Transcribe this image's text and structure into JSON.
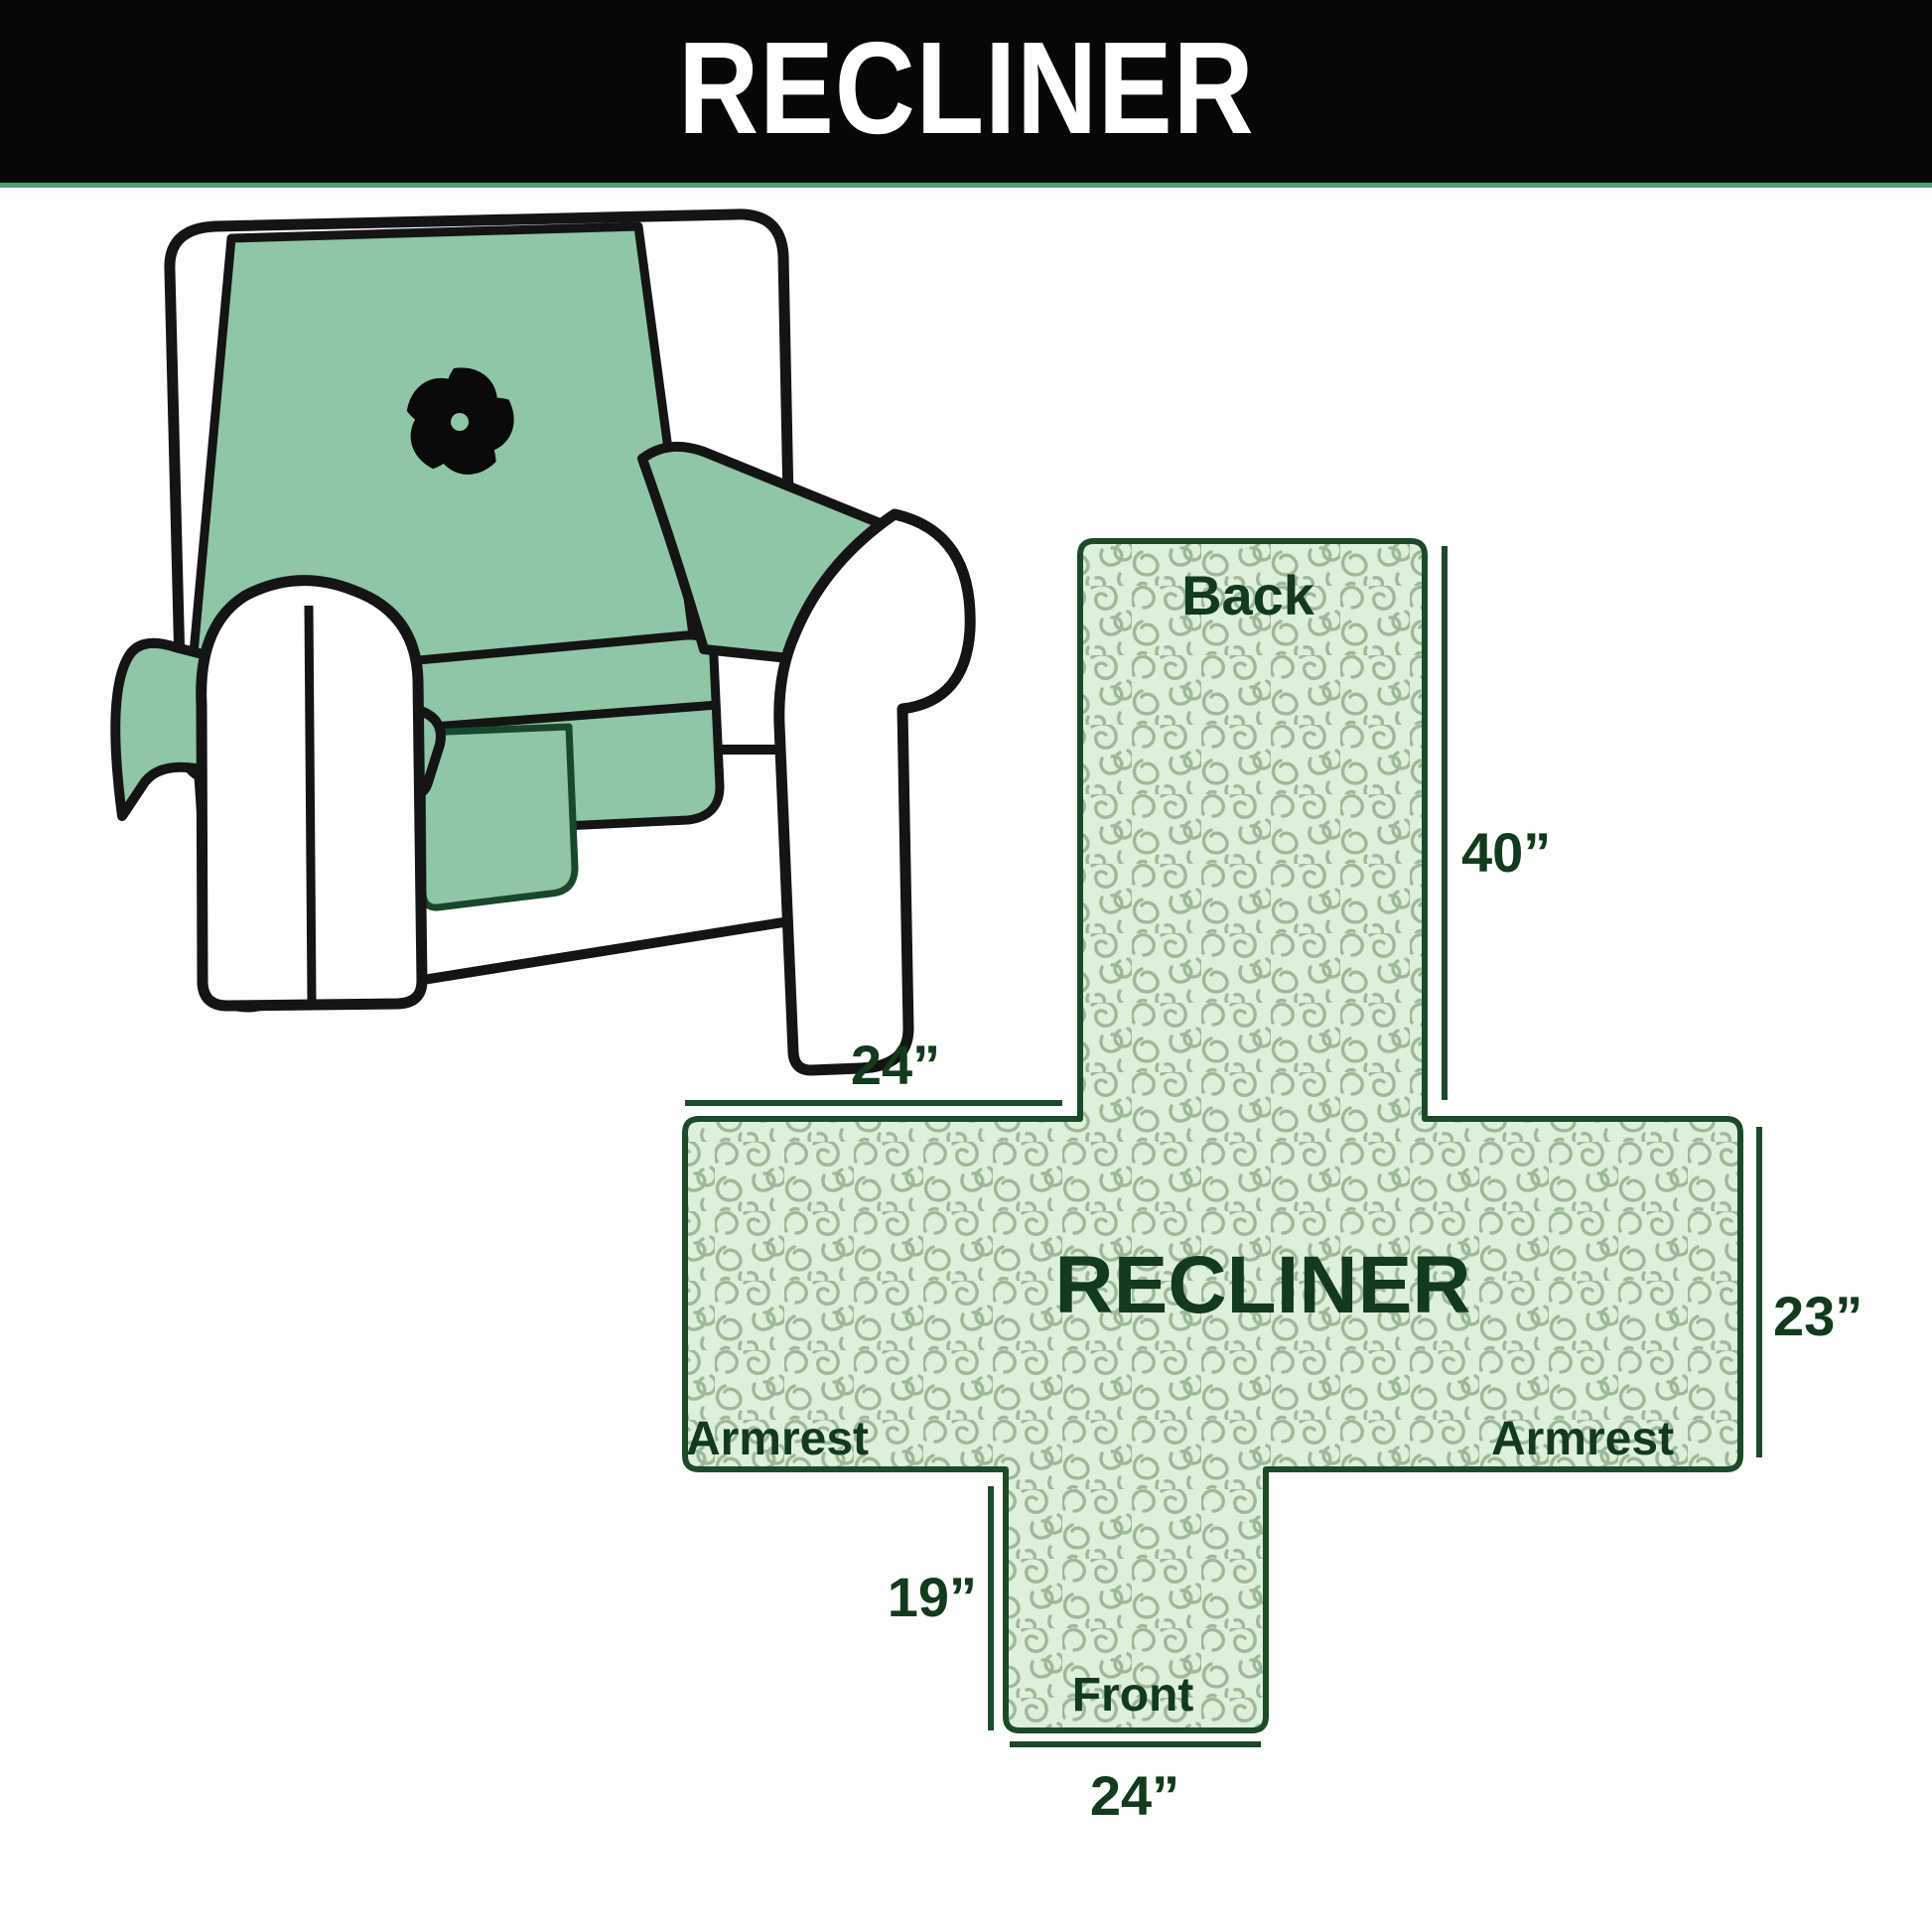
{
  "banner": {
    "title": "RECLINER"
  },
  "illustration": {
    "description": "armchair with quilted slipcover",
    "icon": "pinwheel-fan-icon"
  },
  "diagram": {
    "panel_labels": {
      "back": "Back",
      "center": "RECLINER",
      "armrest_left": "Armrest",
      "armrest_right": "Armrest",
      "front": "Front"
    },
    "dimensions": {
      "back_height": "40”",
      "armrest_top_width": "24”",
      "armrest_side_height": "23”",
      "front_drop_height": "19”",
      "front_width": "24”"
    }
  },
  "colors": {
    "banner_bg": "#070707",
    "banner_text": "#ffffff",
    "banner_underline": "#4d9e6f",
    "cover_green": "#8ec6a6",
    "chair_outline": "#141414",
    "cross_fill": "#ddf0d8",
    "squiggle_line": "#97b394",
    "cross_border": "#1c4a28",
    "label_green": "#123a1c"
  }
}
